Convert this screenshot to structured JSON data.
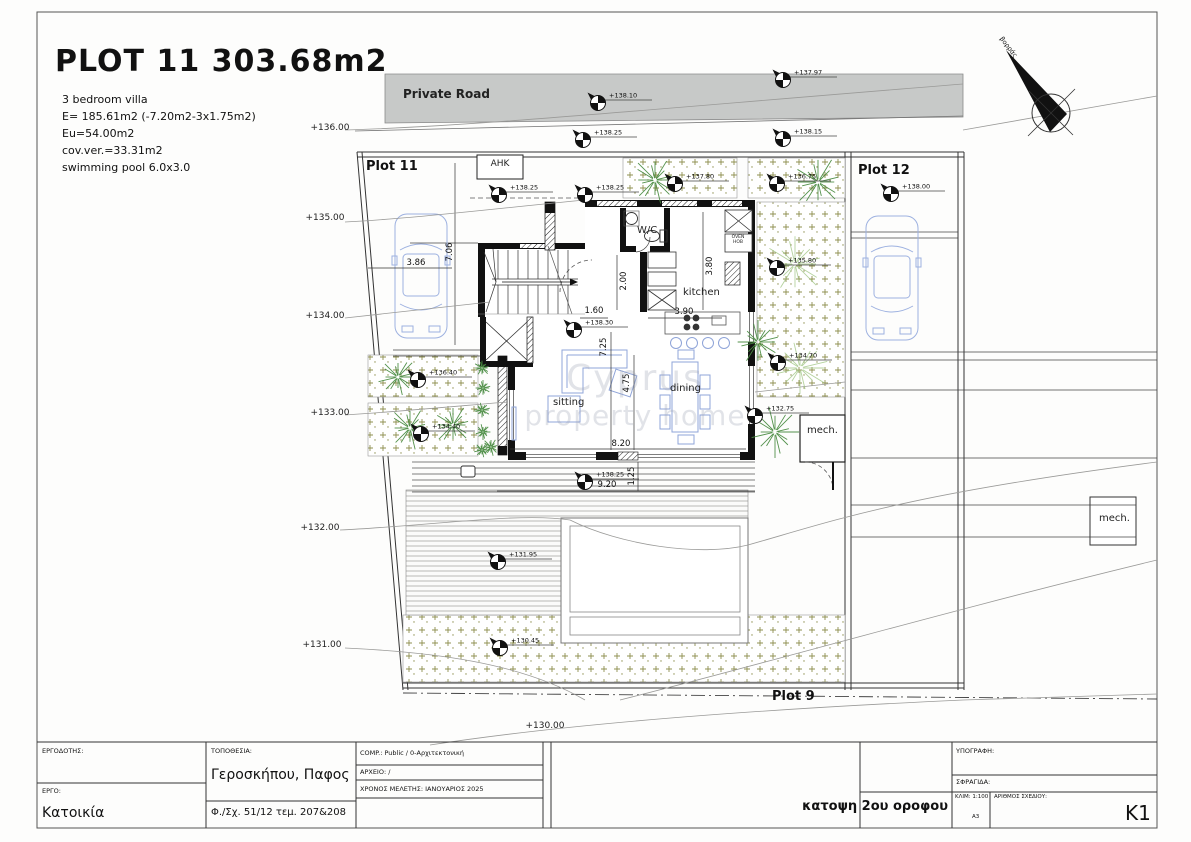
{
  "header": {
    "title": "PLOT 11 303.68m2",
    "specs": [
      "3 bedroom villa",
      "E= 185.61m2 (-7.20m2-3x1.75m2)",
      "Eu=54.00m2",
      "cov.ver.=33.31m2",
      "swimming pool 6.0x3.0"
    ]
  },
  "site": {
    "road_label": "Private Road",
    "north_label": "βορράς",
    "ahk_label": "ΑΗΚ",
    "plots": {
      "plot11": "Plot 11",
      "plot12": "Plot 12",
      "plot9": "Plot 9"
    },
    "rooms": {
      "wc": "W/C",
      "kitchen": "kitchen",
      "sitting": "sitting",
      "dining": "dining",
      "mech": "mech.",
      "mech_right": "mech.",
      "oven_hob": "OVEN HOB"
    },
    "spot_elevations": [
      {
        "x": 598,
        "y": 103,
        "v": "+138.10"
      },
      {
        "x": 583,
        "y": 140,
        "v": "+138.25"
      },
      {
        "x": 783,
        "y": 80,
        "v": "+137.97"
      },
      {
        "x": 783,
        "y": 139,
        "v": "+138.15"
      },
      {
        "x": 891,
        "y": 194,
        "v": "+138.00"
      },
      {
        "x": 499,
        "y": 195,
        "v": "+138.25"
      },
      {
        "x": 585,
        "y": 195,
        "v": "+138.25"
      },
      {
        "x": 675,
        "y": 184,
        "v": "+137.80"
      },
      {
        "x": 777,
        "y": 184,
        "v": "+136.75"
      },
      {
        "x": 777,
        "y": 268,
        "v": "+135.80"
      },
      {
        "x": 778,
        "y": 363,
        "v": "+134.70"
      },
      {
        "x": 755,
        "y": 416,
        "v": "+132.75"
      },
      {
        "x": 418,
        "y": 380,
        "v": "+136.40"
      },
      {
        "x": 421,
        "y": 434,
        "v": "+134.40"
      },
      {
        "x": 574,
        "y": 330,
        "v": "+138.30"
      },
      {
        "x": 585,
        "y": 482,
        "v": "+138.25"
      },
      {
        "x": 498,
        "y": 562,
        "v": "+131.95"
      },
      {
        "x": 500,
        "y": 648,
        "v": "+130.45"
      }
    ],
    "contour_labels": [
      {
        "x": 330,
        "y": 128,
        "v": "+136.00"
      },
      {
        "x": 325,
        "y": 218,
        "v": "+135.00"
      },
      {
        "x": 325,
        "y": 316,
        "v": "+134.00"
      },
      {
        "x": 330,
        "y": 413,
        "v": "+133.00"
      },
      {
        "x": 320,
        "y": 528,
        "v": "+132.00"
      },
      {
        "x": 322,
        "y": 645,
        "v": "+131.00"
      },
      {
        "x": 545,
        "y": 726,
        "v": "+130.00"
      }
    ],
    "dimensions": [
      {
        "x": 416,
        "y": 263,
        "v": "3.86",
        "rot": 0
      },
      {
        "x": 450,
        "y": 252,
        "v": "7.06",
        "rot": 1
      },
      {
        "x": 624,
        "y": 281,
        "v": "2.00",
        "rot": 1
      },
      {
        "x": 594,
        "y": 311,
        "v": "1.60",
        "rot": 0
      },
      {
        "x": 684,
        "y": 312,
        "v": "3.90",
        "rot": 0
      },
      {
        "x": 710,
        "y": 266,
        "v": "3.80",
        "rot": 1
      },
      {
        "x": 604,
        "y": 347,
        "v": "7.25",
        "rot": 1
      },
      {
        "x": 627,
        "y": 383,
        "v": "4.75",
        "rot": 1
      },
      {
        "x": 621,
        "y": 444,
        "v": "8.20",
        "rot": 0
      },
      {
        "x": 607,
        "y": 485,
        "v": "9.20",
        "rot": 0
      },
      {
        "x": 632,
        "y": 476,
        "v": "1.25",
        "rot": 1
      }
    ],
    "trees": [
      {
        "x": 655,
        "y": 180,
        "r": 24,
        "shade": "dark"
      },
      {
        "x": 818,
        "y": 182,
        "r": 26,
        "shade": "dark"
      },
      {
        "x": 795,
        "y": 264,
        "r": 30,
        "shade": "light"
      },
      {
        "x": 758,
        "y": 342,
        "r": 22,
        "shade": "dark"
      },
      {
        "x": 800,
        "y": 368,
        "r": 28,
        "shade": "light"
      },
      {
        "x": 775,
        "y": 432,
        "r": 26,
        "shade": "dark"
      },
      {
        "x": 398,
        "y": 377,
        "r": 20,
        "shade": "dark"
      },
      {
        "x": 410,
        "y": 428,
        "r": 22,
        "shade": "dark"
      },
      {
        "x": 453,
        "y": 425,
        "r": 20,
        "shade": "dark"
      },
      {
        "x": 482,
        "y": 368,
        "r": 8,
        "shade": "dark"
      },
      {
        "x": 483,
        "y": 388,
        "r": 8,
        "shade": "dark"
      },
      {
        "x": 482,
        "y": 410,
        "r": 8,
        "shade": "dark"
      },
      {
        "x": 483,
        "y": 432,
        "r": 8,
        "shade": "dark"
      },
      {
        "x": 482,
        "y": 450,
        "r": 8,
        "shade": "dark"
      },
      {
        "x": 491,
        "y": 447,
        "r": 9,
        "shade": "dark"
      }
    ]
  },
  "watermark": {
    "line1": "Cyprus",
    "line2": "property home"
  },
  "titleblock": {
    "ergodotis_label": "ΕΡΓΟΔΟΤΗΣ:",
    "ergo_label": "ΕΡΓΟ:",
    "ergo_value": "Κατοικία",
    "topothesia_label": "ΤΟΠΟΘΕΣΙΑ:",
    "topothesia_value": "Γεροσκήπου, Παφος",
    "sheet_ref": "Φ./Σχ. 51/12  τεμ. 207&208",
    "comp": "COMP.: Public / 0-Αρχιτεκτονική",
    "archio": "ΑΡΧΕΙΟ: /",
    "xronos": "ΧΡΟΝΟΣ ΜΕΛΕΤΗΣ: ΙΑΝΟΥΑΡΙΟΣ 2025",
    "ypografi": "ΥΠΟΓΡΑΦΗ:",
    "sfragida": "ΣΦΡΑΓΙΔΑ:",
    "drawing_title": "κατοψη 2ου οροφου",
    "klim": "ΚΛΙΜ: 1:100",
    "paper": "A3",
    "arithmos_label": "ΑΡΙΘΜΟΣ ΣΧΕΔΙΟΥ:",
    "number": "K1"
  },
  "colors": {
    "furniture": "#8fa4d8",
    "tree_dark": "#4a8c42",
    "tree_light": "#9cc47e",
    "road": "#c7c9c8",
    "garden": "#8f9050"
  }
}
